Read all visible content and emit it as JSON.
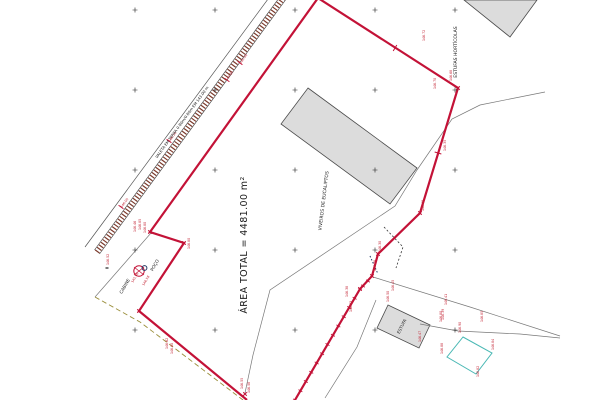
{
  "plan": {
    "area_total_label": "ÁREA TOTAL = 4481.00 m²",
    "labels": {
      "viveiros": "VIVEIROS DE EUCALIPTOS",
      "estufas_horticolas": "ESTUFAS HORTÍCOLAS",
      "estufa": "ESTUFA",
      "poco": "POÇO",
      "cabine": "CABINE",
      "valeta": "VALETA EM TERRA 0.80m/0.80m EM 143.00 m"
    },
    "colors": {
      "boundary_red": "#c31237",
      "band_hatch": "#7c3b2d",
      "fence_gray": "#787878",
      "hedge_dash": "#9a8e3a",
      "survey_quad_cyan": "#49b8b4",
      "building_fill": "#dcdcdc",
      "building_stroke": "#4a4a4a",
      "label_red": "#c22031",
      "text_black": "#1a1a1a",
      "navy": "#223a66"
    },
    "point_labels": [
      {
        "text": "146.46",
        "x": 136,
        "y": 232,
        "rot": -90
      },
      {
        "text": "146.85",
        "x": 141,
        "y": 230,
        "rot": -90
      },
      {
        "text": "146.80",
        "x": 146,
        "y": 233,
        "rot": -90
      },
      {
        "text": "146.80",
        "x": 190,
        "y": 249,
        "rot": -90
      },
      {
        "text": "146.52",
        "x": 109,
        "y": 265,
        "rot": -90
      },
      {
        "text": "145.96",
        "x": 133,
        "y": 283,
        "rot": -60
      },
      {
        "text": "146.58",
        "x": 144,
        "y": 286,
        "rot": -60
      },
      {
        "text": "146.62",
        "x": 168,
        "y": 349,
        "rot": -90
      },
      {
        "text": "146.60",
        "x": 173,
        "y": 354,
        "rot": -90
      },
      {
        "text": "146.55",
        "x": 243,
        "y": 389,
        "rot": -90
      },
      {
        "text": "146.58",
        "x": 250,
        "y": 393,
        "rot": -90
      },
      {
        "text": "146.72",
        "x": 425,
        "y": 41,
        "rot": -90
      },
      {
        "text": "146.68",
        "x": 452,
        "y": 81,
        "rot": -90
      },
      {
        "text": "146.70",
        "x": 436,
        "y": 89,
        "rot": -90
      },
      {
        "text": "146.35",
        "x": 446,
        "y": 151,
        "rot": -90
      },
      {
        "text": "146.40",
        "x": 424,
        "y": 211,
        "rot": -90
      },
      {
        "text": "146.30",
        "x": 381,
        "y": 252,
        "rot": -90
      },
      {
        "text": "146.28",
        "x": 376,
        "y": 271,
        "rot": -90
      },
      {
        "text": "146.38",
        "x": 348,
        "y": 297,
        "rot": -90
      },
      {
        "text": "146.33",
        "x": 352,
        "y": 312,
        "rot": -90
      },
      {
        "text": "146.45",
        "x": 394,
        "y": 291,
        "rot": -90
      },
      {
        "text": "146.41",
        "x": 447,
        "y": 305,
        "rot": -90
      },
      {
        "text": "146.39",
        "x": 444,
        "y": 320,
        "rot": -90
      },
      {
        "text": "146.50",
        "x": 389,
        "y": 302,
        "rot": -90
      },
      {
        "text": "146.47",
        "x": 421,
        "y": 342,
        "rot": -90
      },
      {
        "text": "146.90",
        "x": 461,
        "y": 333,
        "rot": -90
      },
      {
        "text": "146.84",
        "x": 494,
        "y": 350,
        "rot": -90
      },
      {
        "text": "146.82",
        "x": 479,
        "y": 377,
        "rot": -90
      },
      {
        "text": "146.88",
        "x": 443,
        "y": 354,
        "rot": -90
      },
      {
        "text": "146.85",
        "x": 483,
        "y": 322,
        "rot": -90
      },
      {
        "text": "146.80",
        "x": 442,
        "y": 322,
        "rot": -90
      },
      {
        "text": "145.90",
        "x": 241,
        "y": 64,
        "rot": -54
      },
      {
        "text": "145.85",
        "x": 227,
        "y": 81,
        "rot": -54
      },
      {
        "text": "146.10",
        "x": 170,
        "y": 142,
        "rot": -54
      },
      {
        "text": "146.05",
        "x": 122,
        "y": 208,
        "rot": -54
      }
    ]
  }
}
